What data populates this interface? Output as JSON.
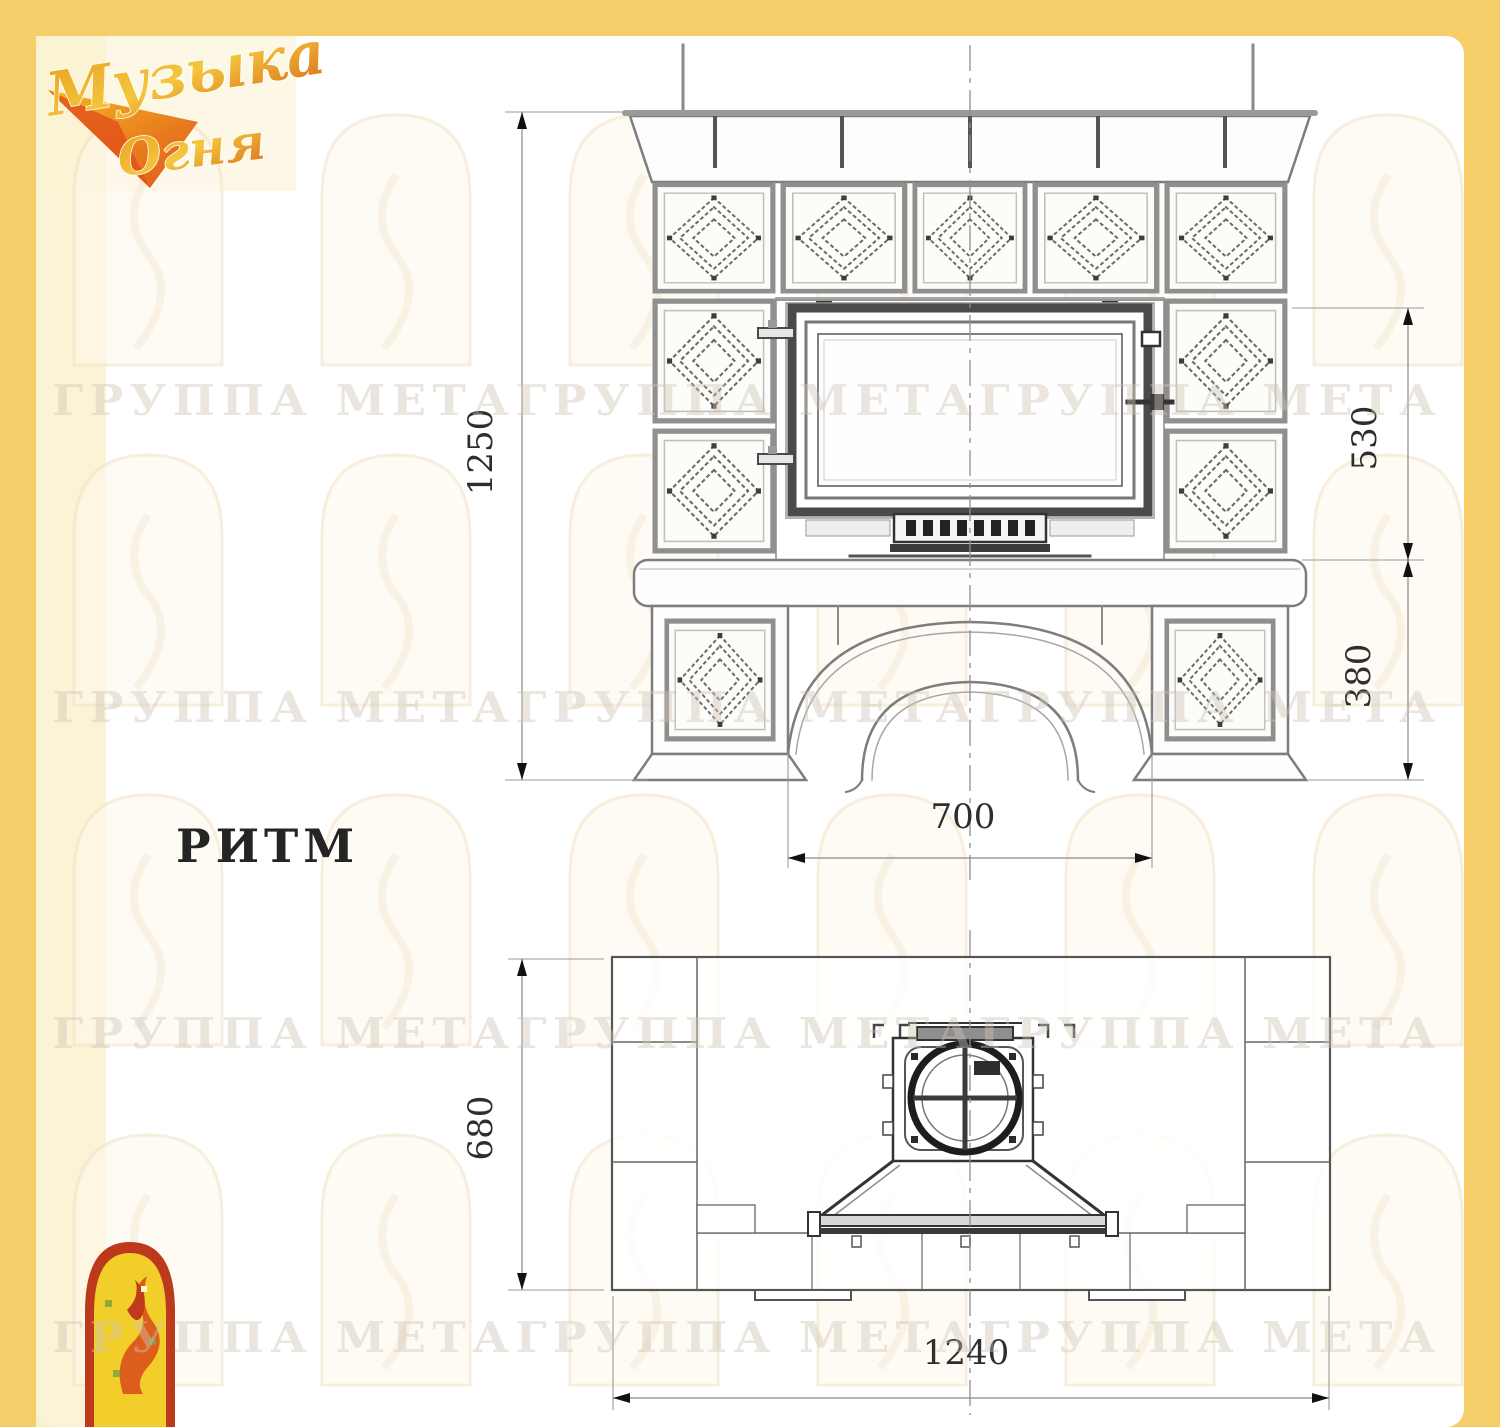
{
  "logo": {
    "line1": "Музыка",
    "line2": "Огня"
  },
  "model": {
    "label": "РИТМ"
  },
  "watermark": {
    "text": "ГРУППА МЕТАГРУППА МЕТАГРУППА МЕТА"
  },
  "dims": {
    "front_height": "1250",
    "front_upper": "530",
    "front_lower": "380",
    "front_arch_width": "700",
    "plan_depth": "680",
    "plan_width": "1240"
  }
}
